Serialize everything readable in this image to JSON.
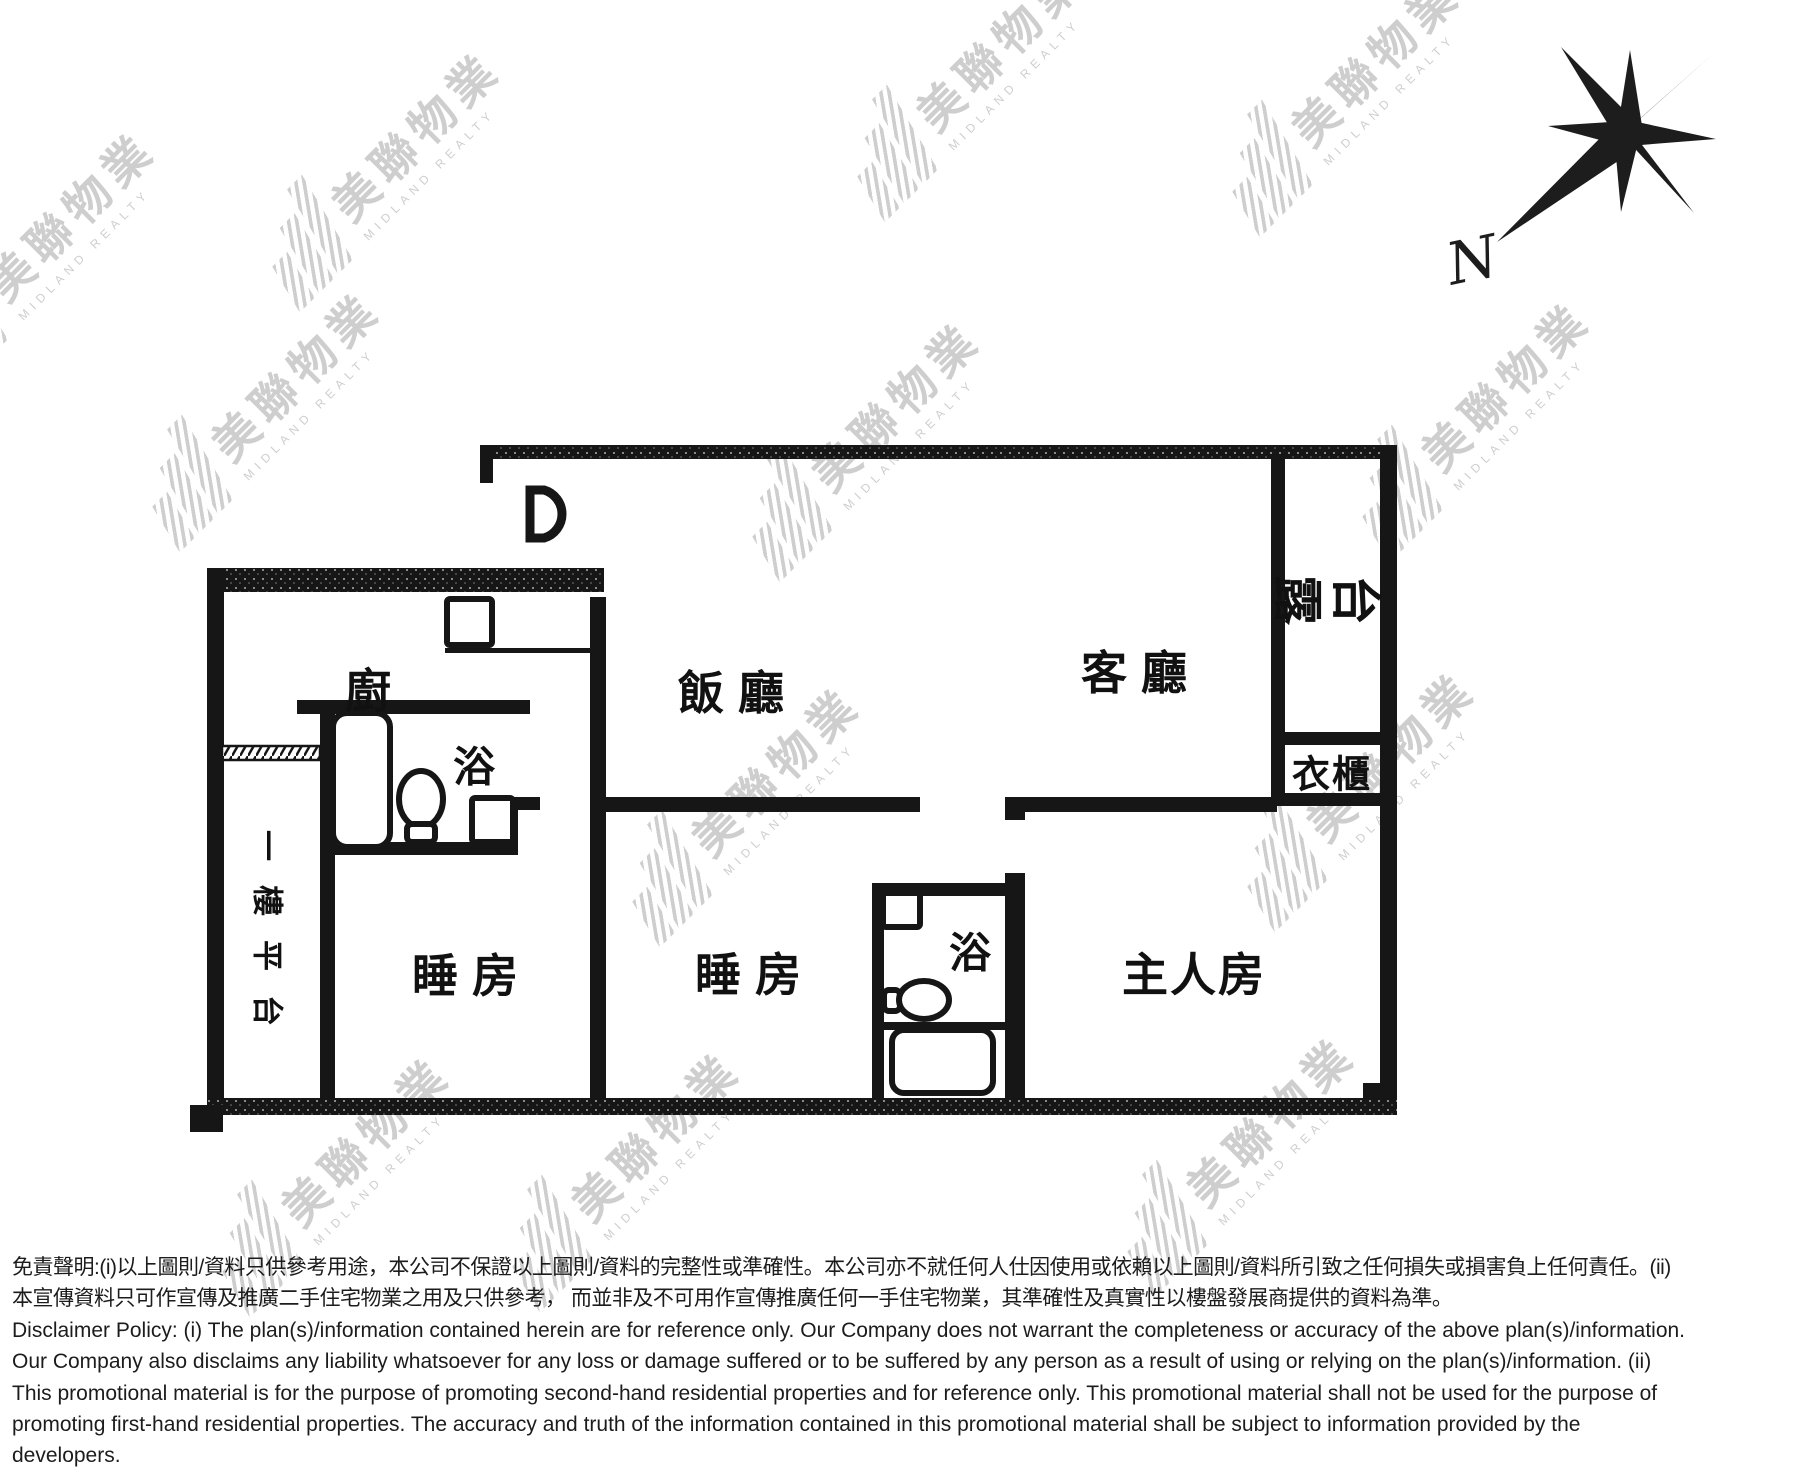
{
  "page": {
    "width": 1811,
    "height": 1479,
    "background": "#ffffff"
  },
  "colors": {
    "wall": "#161616",
    "label_text": "#111111",
    "watermark": "#c9c9c9",
    "disclaimer_text": "#1c1c1c"
  },
  "compass": {
    "label": "N"
  },
  "watermark": {
    "cjk": "美聯物業",
    "en": "MIDLAND REALTY"
  },
  "floor_plan": {
    "rooms": {
      "kitchen": {
        "label": "廚"
      },
      "dining_room": {
        "label": "飯廳"
      },
      "living_room": {
        "label": "客廳"
      },
      "balcony": {
        "chars": [
          "露",
          "台"
        ]
      },
      "wardrobe": {
        "label": "衣櫃"
      },
      "bathroom_1": {
        "label": "浴"
      },
      "bathroom_2": {
        "label": "浴"
      },
      "bedroom_1": {
        "label": "睡房"
      },
      "bedroom_2": {
        "label": "睡房"
      },
      "master_bedroom": {
        "label": "主人房"
      },
      "platform": {
        "chars": [
          "一",
          "樓",
          "平",
          "台"
        ]
      }
    }
  },
  "disclaimer": {
    "lines": [
      "免責聲明:(i)以上圖則/資料只供參考用途，本公司不保證以上圖則/資料的完整性或準確性。本公司亦不就任何人仕因使用或依賴以上圖則/資料所引致之任何損失或損害負上任何責任。(ii)",
      "本宣傳資料只可作宣傳及推廣二手住宅物業之用及只供參考， 而並非及不可用作宣傳推廣任何一手住宅物業，其準確性及真實性以樓盤發展商提供的資料為準。",
      "Disclaimer Policy: (i) The plan(s)/information contained herein are for reference only. Our Company does not warrant the completeness or accuracy of the above plan(s)/information.",
      "Our Company also disclaims any liability whatsoever for any loss or damage suffered or to be suffered by any person as a result of using or relying on the plan(s)/information. (ii)",
      "This promotional material is for the purpose of promoting second-hand residential properties and for reference only. This promotional material shall not be used for the purpose of",
      "promoting first-hand residential properties. The accuracy and truth of the information contained in this promotional material shall be subject to information provided by the",
      "developers."
    ]
  }
}
